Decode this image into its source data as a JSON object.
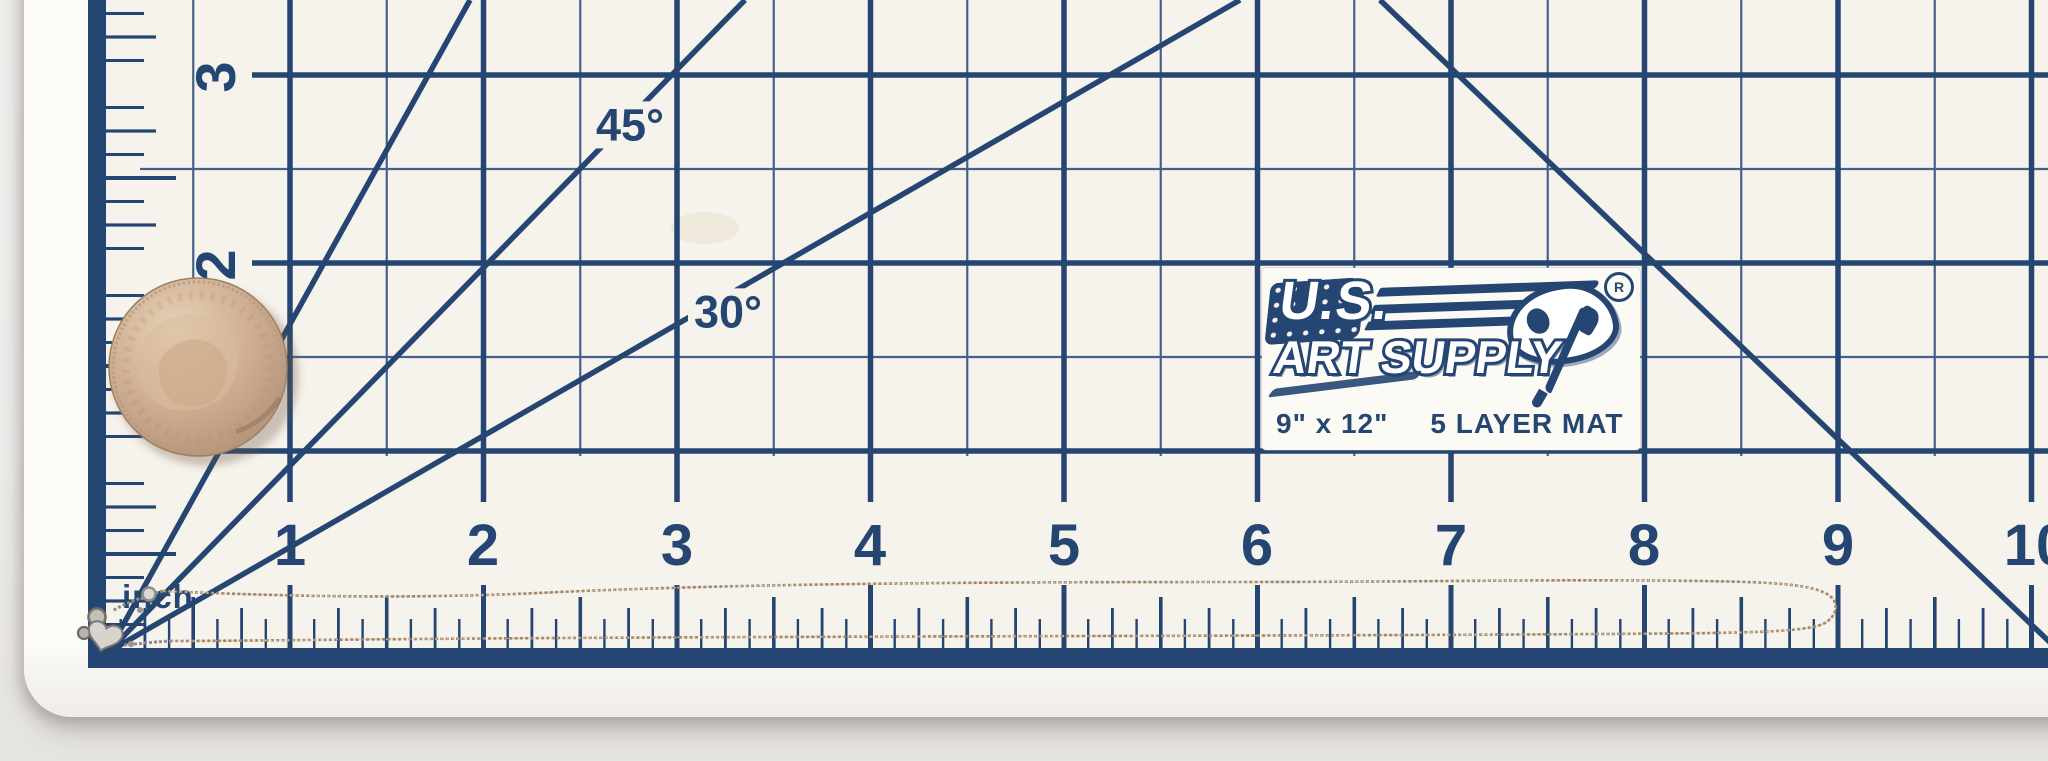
{
  "photo": {
    "mat": {
      "logo": {
        "brand_top": "U.S.",
        "brand_bottom": "ART SUPPLY",
        "registered_mark": "R",
        "size_label": "9\" x 12\"",
        "layer_label": "5 LAYER MAT"
      },
      "unit_label": "inch",
      "angle_labels": {
        "a45": "45°",
        "a30": "30°"
      },
      "ruler_bottom": {
        "labels": [
          "1",
          "2",
          "3",
          "4",
          "5",
          "6",
          "7",
          "8",
          "9",
          "10"
        ]
      },
      "ruler_left": {
        "labels": [
          "3",
          "2"
        ]
      },
      "colors": {
        "grid_navy": "#254672",
        "grid_thin": "#44618c",
        "mat_surface": "#f6f3ec",
        "mat_edge": "#fcfbf8",
        "table": "#eeedeb"
      }
    },
    "objects": {
      "coin": {
        "name": "us-quarter-coin",
        "color": "#cfaf92"
      },
      "necklace": {
        "name": "fine-chain-necklace",
        "chain_color": "#a1866a",
        "clasp_color": "#c9c5bf"
      }
    }
  }
}
